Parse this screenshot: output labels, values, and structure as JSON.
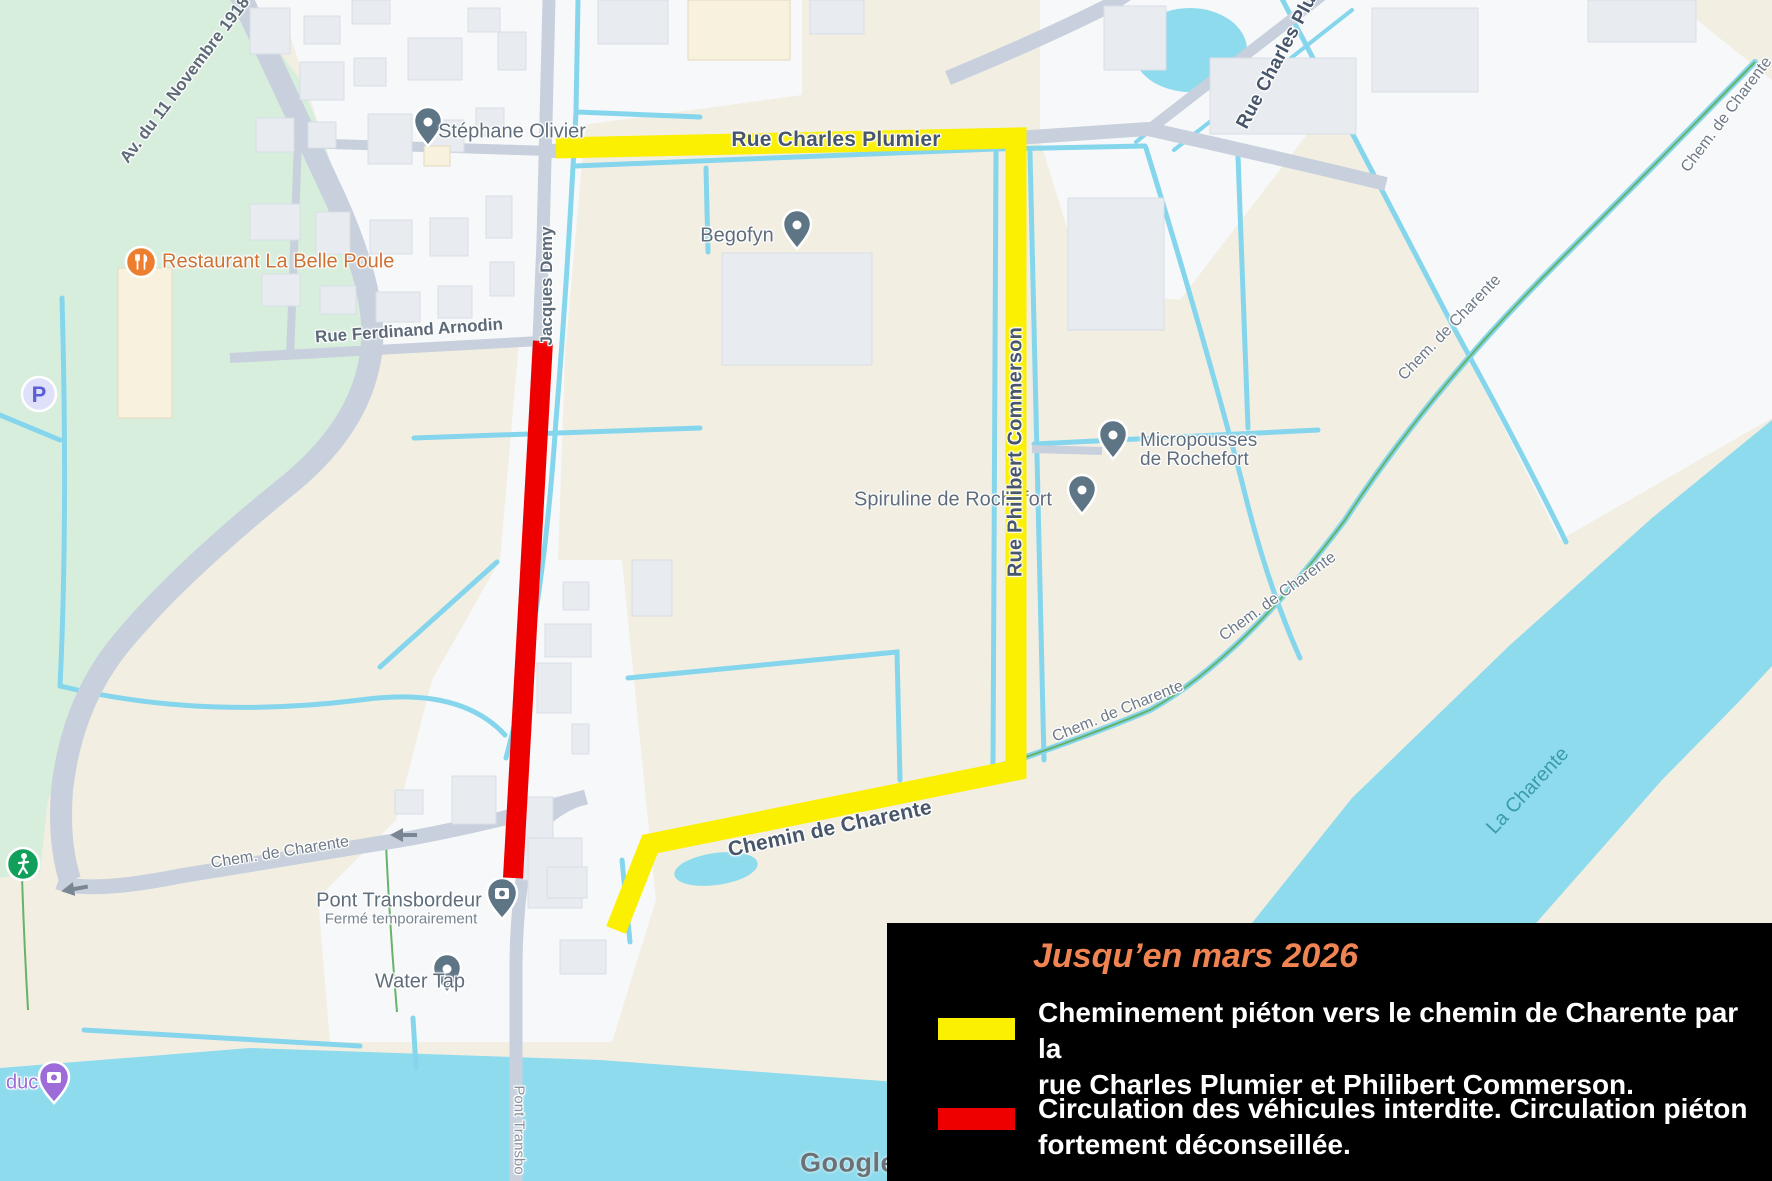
{
  "map": {
    "street_labels": {
      "rue_charles_plumier": "Rue Charles Plumier",
      "rue_charles_plumier_truncated": "Rue Charles Plu",
      "rue_philibert_commerson": "Rue Philibert Commerson",
      "rue_ferdinand_arnodin": "Rue Ferdinand Arnodin",
      "rue_jacques_demy": "Jacques Demy",
      "avenue_11_novembre": "Av. du 11 Novembre 1918",
      "chemin_de_charente": "Chemin de Charente",
      "chem_de_charente_abbrev": "Chem. de Charente",
      "pont_road_truncated": "Pont Transbo",
      "la_charente": "La Charente"
    },
    "pois": {
      "stephane_olivier": "Stéphane Olivier",
      "begofyn": "Begofyn",
      "restaurant": "Restaurant La Belle Poule",
      "micropousses_line1": "Micropousses",
      "micropousses_line2": "de Rochefort",
      "spiruline": "Spiruline de Rochefort",
      "pont_transbordeur": "Pont Transbordeur",
      "pont_transbordeur_status": "Fermé temporairement",
      "water_tap": "Water Tap",
      "viaduc_fragment": "duc",
      "parking_letter": "P"
    },
    "watermark": "Google"
  },
  "legend": {
    "title": "Jusqu’en mars 2026",
    "items": [
      {
        "color": "#FAF000",
        "text": "Cheminement piéton vers le chemin de Charente par la\nrue Charles Plumier et Philibert Commerson."
      },
      {
        "color": "#EE0000",
        "text": "Circulation des véhicules interdite. Circulation piéton\nfortement déconseillée."
      }
    ]
  },
  "colors": {
    "route_pedestrian": "#FAF000",
    "route_forbidden": "#EE0000",
    "legend_bg": "#000000",
    "legend_title": "#EF8351",
    "water": "#8EDBEE",
    "park": "#D8EEDD",
    "road": "#C7D0DC",
    "field": "#F2EEE2",
    "building": "#E8EBF0"
  }
}
